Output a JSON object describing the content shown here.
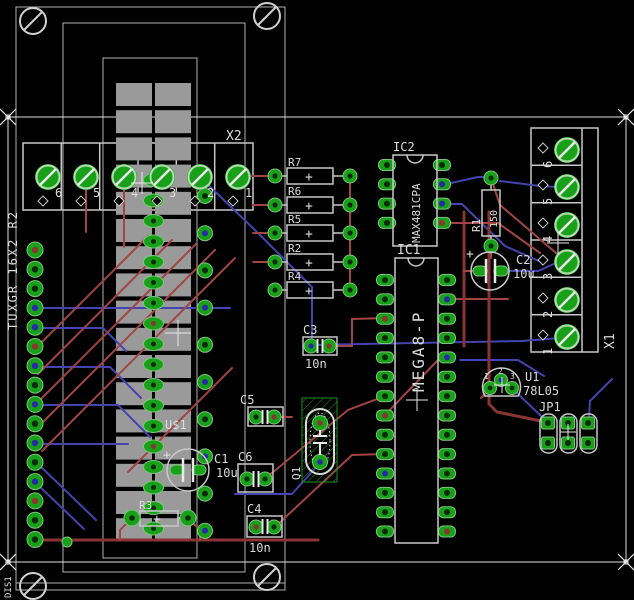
{
  "canvas": {
    "type": "pcb-board-layout"
  },
  "symbols": {
    "plus": "+"
  },
  "colors": {
    "background": "#000000",
    "silkscreen": "#c8c8c8",
    "top_trace": "#a24444",
    "bottom_trace": "#4444b0",
    "pad_green": "#18a018",
    "lcd_pad_gray": "#9a9a9a"
  },
  "display": {
    "name": "U$1",
    "type_label": "TUXGR 16X2 R2",
    "board_label": "DIS1"
  },
  "connectors": {
    "x2": {
      "name": "X2",
      "pins": [
        "6",
        "5",
        "4",
        "3",
        "2",
        "1"
      ]
    },
    "x1": {
      "name": "X1",
      "pins": [
        "6",
        "5",
        "4",
        "3",
        "2",
        "1"
      ]
    },
    "jp1": {
      "name": "JP1"
    }
  },
  "ics": {
    "ic1": {
      "name": "IC1",
      "value": "MEGA8-P"
    },
    "ic2": {
      "name": "IC2",
      "value": "MAX481CPA"
    }
  },
  "resistors": {
    "r1": {
      "name": "R1",
      "value": "150"
    },
    "r2": {
      "name": "R2"
    },
    "r3": {
      "name": "R3"
    },
    "r4": {
      "name": "R4"
    },
    "r5": {
      "name": "R5"
    },
    "r6": {
      "name": "R6"
    },
    "r7": {
      "name": "R7"
    }
  },
  "capacitors": {
    "c1": {
      "name": "C1",
      "value": "10u"
    },
    "c2": {
      "name": "C2",
      "value": "10u"
    },
    "c3": {
      "name": "C3",
      "value": "10n"
    },
    "c4": {
      "name": "C4",
      "value": "10n"
    },
    "c5": {
      "name": "C5"
    },
    "c6": {
      "name": "C6"
    }
  },
  "crystal": {
    "name": "Q1"
  },
  "regulator": {
    "name": "U1",
    "value": "78L05",
    "pins": [
      "1",
      "2",
      "3"
    ]
  }
}
